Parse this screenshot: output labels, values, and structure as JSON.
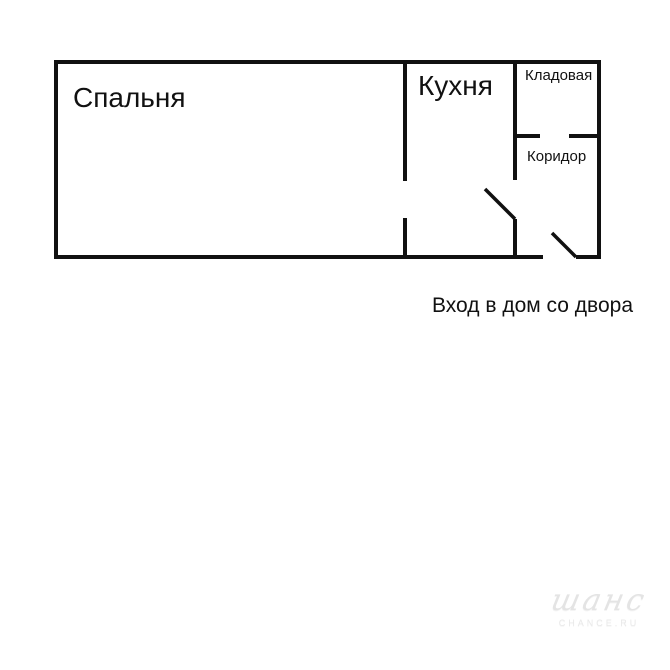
{
  "plan": {
    "rooms": {
      "bedroom": {
        "label": "Спальня"
      },
      "kitchen": {
        "label": "Кухня"
      },
      "pantry": {
        "label": "Кладовая"
      },
      "corridor": {
        "label": "Коридор"
      }
    },
    "entrance_caption": "Вход в дом со двора",
    "wall_color": "#111111",
    "background_color": "#ffffff"
  },
  "watermark": {
    "logo_text": "шанс",
    "site_text": "CHANCE.RU"
  }
}
